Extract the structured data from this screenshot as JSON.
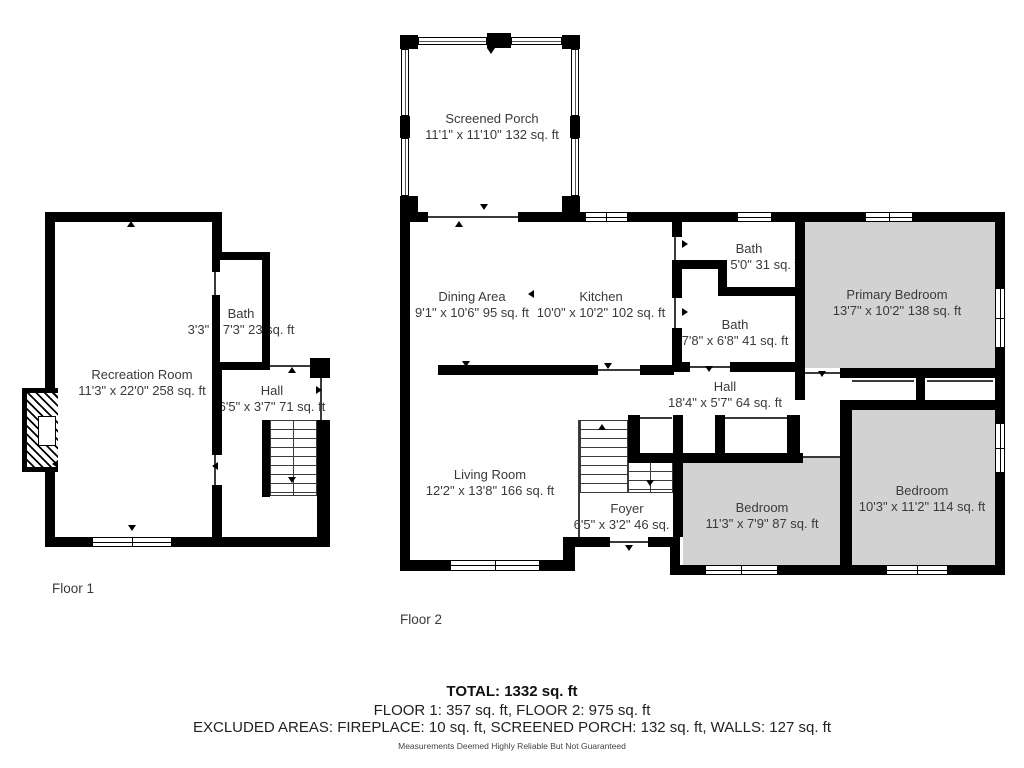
{
  "floor1": {
    "label": "Floor 1",
    "rooms": {
      "recreation": {
        "name": "Recreation Room",
        "dims": "11'3\" x 22'0\" 258 sq. ft"
      },
      "bath": {
        "name": "Bath",
        "dims": "3'3\" x 7'3\" 23 sq. ft"
      },
      "hall": {
        "name": "Hall",
        "dims": "6'5\" x 3'7\" 71 sq. ft"
      }
    }
  },
  "floor2": {
    "label": "Floor 2",
    "rooms": {
      "screened_porch": {
        "name": "Screened Porch",
        "dims": "11'1\" x 11'10\" 132 sq. ft"
      },
      "dining": {
        "name": "Dining Area",
        "dims": "9'1\" x 10'6\" 95 sq. ft"
      },
      "kitchen": {
        "name": "Kitchen",
        "dims": "10'0\" x 10'2\" 102 sq. ft"
      },
      "bath_small": {
        "name": "Bath",
        "dims": "x 5'0\" 31 sq. ft"
      },
      "bath_large": {
        "name": "Bath",
        "dims": "7'8\" x 6'8\" 41 sq. ft"
      },
      "primary_bedroom": {
        "name": "Primary Bedroom",
        "dims": "13'7\" x 10'2\" 138 sq. ft"
      },
      "hall": {
        "name": "Hall",
        "dims": "18'4\" x 5'7\" 64 sq. ft"
      },
      "living": {
        "name": "Living Room",
        "dims": "12'2\" x 13'8\" 166 sq. ft"
      },
      "foyer": {
        "name": "Foyer",
        "dims": "6'5\" x 3'2\" 46 sq. ft"
      },
      "bedroom_87": {
        "name": "Bedroom",
        "dims": "11'3\" x 7'9\" 87 sq. ft"
      },
      "bedroom_114": {
        "name": "Bedroom",
        "dims": "10'3\" x 11'2\" 114 sq. ft"
      }
    }
  },
  "summary": {
    "total": "TOTAL: 1332 sq. ft",
    "floors": "FLOOR 1: 357 sq. ft, FLOOR 2: 975 sq. ft",
    "excluded": "EXCLUDED AREAS: FIREPLACE: 10 sq. ft, SCREENED PORCH: 132 sq. ft, WALLS: 127 sq. ft",
    "disclaimer": "Measurements Deemed Highly Reliable But Not Guaranteed"
  },
  "colors": {
    "wall": "#000000",
    "carpet": "#d2d2d2",
    "text": "#3a3a3a"
  }
}
